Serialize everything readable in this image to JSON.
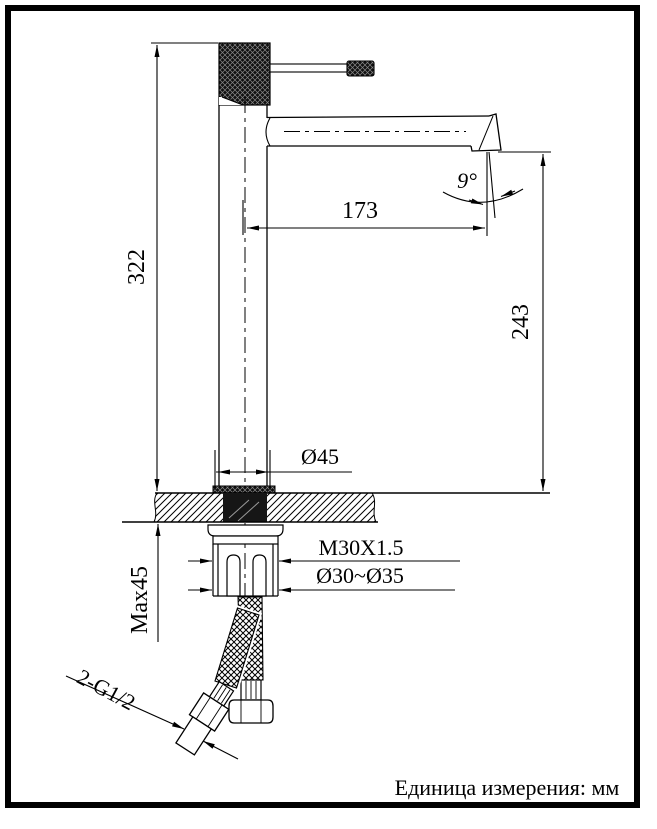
{
  "drawing": {
    "dimensions": {
      "total_height": "322",
      "spout_reach": "173",
      "outlet_height": "243",
      "outlet_angle": "9°",
      "escutcheon_diameter": "Ø45",
      "mounting_thread": "M30X1.5",
      "mounting_hole_diameter": "Ø30~Ø35",
      "max_mounting_thickness": "Max45",
      "inlet_connection": "2-G1/2"
    },
    "footer_note": "Единица измерения: мм"
  }
}
